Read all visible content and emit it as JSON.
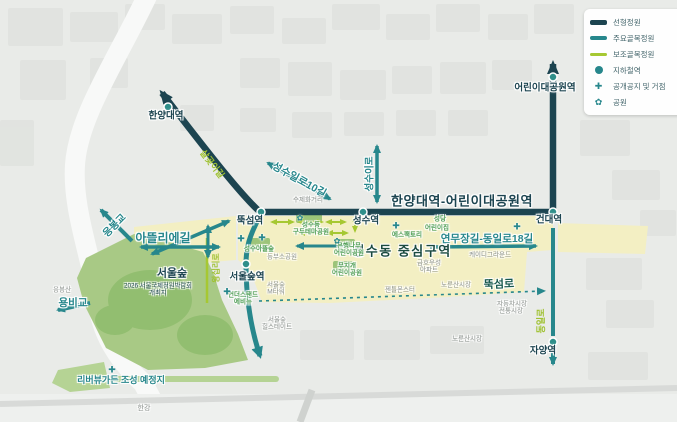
{
  "colors": {
    "linear_garden": "#1c4450",
    "major_alley_garden": "#27878c",
    "minor_alley_garden": "#a6c832",
    "center_zone_fill": "#f3efc3",
    "forest_fill": "#a8c985",
    "background": "#e9ebe8"
  },
  "legend": {
    "items": [
      {
        "label": "선형정원",
        "symbol": "thick-navy-line"
      },
      {
        "label": "주요골목정원",
        "symbol": "teal-line"
      },
      {
        "label": "보조골목정원",
        "symbol": "lime-line"
      },
      {
        "label": "지하철역",
        "symbol": "teal-dot"
      },
      {
        "label": "공개공지 및 거점",
        "symbol": "teal-plus"
      },
      {
        "label": "공원",
        "symbol": "teal-flower"
      }
    ]
  },
  "stations": [
    {
      "id": "hanyang-univ",
      "label": "한양대역"
    },
    {
      "id": "ttukseom",
      "label": "뚝섬역"
    },
    {
      "id": "seongsu",
      "label": "성수역"
    },
    {
      "id": "kondae",
      "label": "건대역"
    },
    {
      "id": "childrens-grand-park",
      "label": "어린이대공원역"
    },
    {
      "id": "seoul-forest",
      "label": "서울숲역"
    },
    {
      "id": "jayang",
      "label": "자양역"
    }
  ],
  "corridors": {
    "linear_garden": "한양대역-어린이대공원역",
    "yeonmujang": "연무장길-동일로18길",
    "atelier_gil": "아뜰리에길",
    "seongsu_ilro_10gil": "성수일로10길",
    "seongsu_iro": "성수이로",
    "ttukseom_ro": "뚝섬로",
    "dongil_ro": "동일로",
    "wangsimni_ro": "왕십리로",
    "salgoji_gil": "살곶이길",
    "eungbong_bridge": "응봉교",
    "yongbi_bridge": "용비교"
  },
  "areas": {
    "center_zone": "성수동 중심구역",
    "seoul_forest": "서울숲",
    "expo_line1": "2026 서울국제정원박람회",
    "expo_line2": "개최지",
    "riverview_garden": "리버뷰가든 조성 예정지",
    "han_river": "한강",
    "eungbongsan": "응봉산"
  },
  "places": [
    {
      "lines": [
        "성수동",
        "구두테마공원"
      ]
    },
    {
      "lines": [
        "성수아뜰숲"
      ]
    },
    {
      "lines": [
        "은행나무",
        "어린이공원"
      ]
    },
    {
      "lines": [
        "무지개",
        "어린이공원"
      ]
    },
    {
      "lines": [
        "성당"
      ]
    },
    {
      "lines": [
        "어린이집"
      ]
    },
    {
      "lines": [
        "에스팩토리"
      ]
    },
    {
      "lines": [
        "언더스탠드",
        "에비뉴"
      ]
    }
  ],
  "landmarks": [
    {
      "lines": [
        "수제화거리"
      ]
    },
    {
      "lines": [
        "서울숲",
        "M타워"
      ]
    },
    {
      "lines": [
        "서울숲",
        "힐스테이트"
      ]
    },
    {
      "lines": [
        "동부소공원"
      ]
    },
    {
      "lines": [
        "케이디그라운드"
      ]
    },
    {
      "lines": [
        "금호우성",
        "아파트"
      ]
    },
    {
      "lines": [
        "젠틀몬스터"
      ]
    },
    {
      "lines": [
        "노룬산시장"
      ]
    },
    {
      "lines": [
        "노룬산시장"
      ]
    },
    {
      "lines": [
        "자동차시장"
      ]
    },
    {
      "lines": [
        "전통시장"
      ]
    }
  ]
}
